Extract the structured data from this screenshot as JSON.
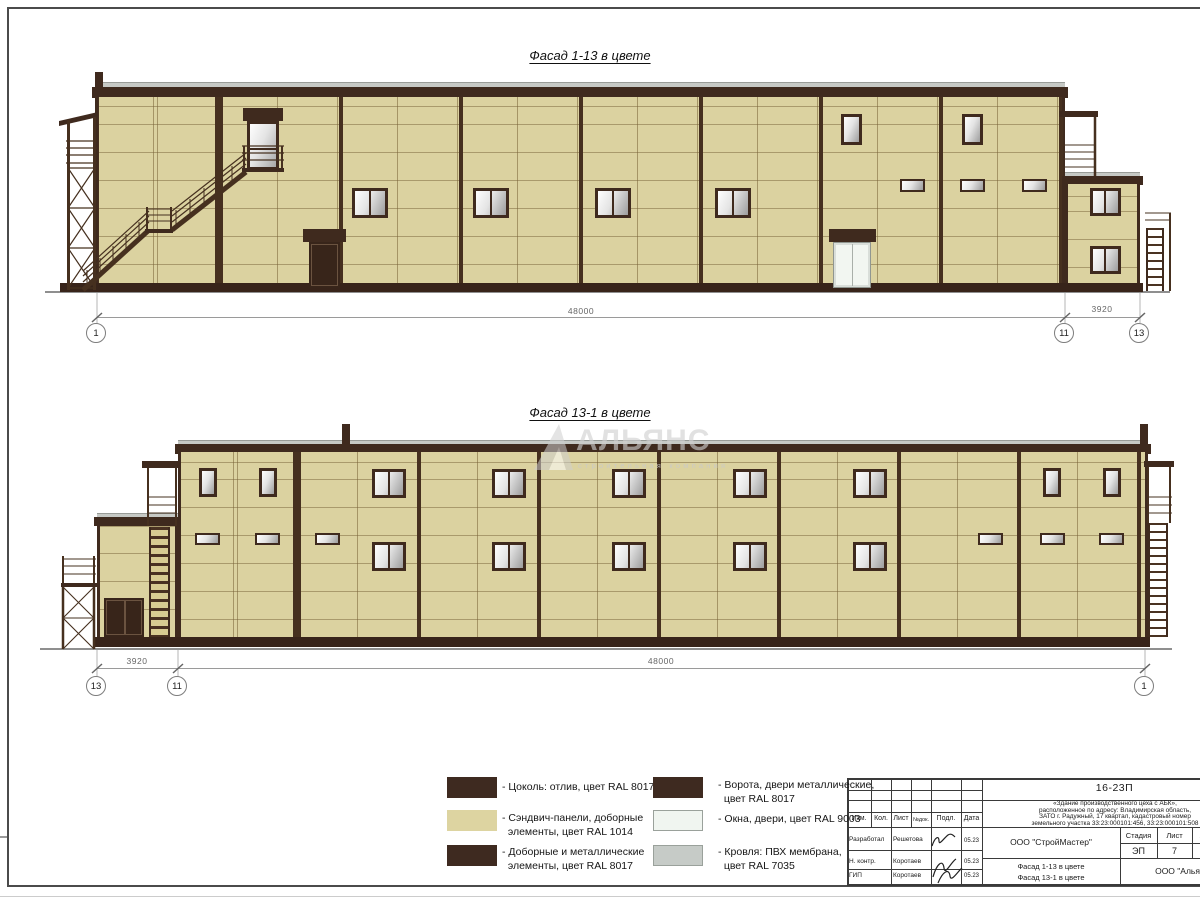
{
  "sheet": {
    "facade_top": {
      "title": "Фасад 1-13 в цвете",
      "dim_main": "48000",
      "dim_annex": "3920",
      "axis_left": "1",
      "axis_mid": "11",
      "axis_right": "13"
    },
    "facade_bottom": {
      "title": "Фасад 13-1 в цвете",
      "dim_annex": "3920",
      "dim_main": "48000",
      "axis_left": "13",
      "axis_mid": "11",
      "axis_right": "1"
    },
    "watermark": {
      "name": "АЛЬЯНС",
      "subtitle": "строительная компания"
    },
    "colors": {
      "panel_beige_ral1014": "#DDD4A1",
      "trim_brown_ral8017": "#3E2A20",
      "window_white_ral9003": "#F0F5F0",
      "roof_gray_ral7035": "#C6CBC7"
    },
    "legend": {
      "items": [
        {
          "color": "#3E2A20",
          "label": "- Цоколь: отлив, цвет RAL 8017"
        },
        {
          "color": "#DDD4A1",
          "label": "- Сэндвич-панели, доборные\n  элементы, цвет RAL 1014"
        },
        {
          "color": "#3E2A20",
          "label": "- Доборные и металлические\n  элементы, цвет RAL 8017"
        },
        {
          "color": "#3E2A20",
          "label": "- Ворота, двери металлические,\n  цвет RAL 8017"
        },
        {
          "color": "#F0F5F0",
          "label": "- Окна, двери, цвет RAL 9003"
        },
        {
          "color": "#C6CBC7",
          "label": "- Кровля: ПВХ мембрана,\n  цвет RAL 7035"
        }
      ]
    },
    "titleblock": {
      "doc_number": "16-23П",
      "description": "«Здание производственного цеха с АБК»,\nрасположенное по адресу: Владимирская область,\nЗАТО г. Радужный, 17 квартал, кадастровый номер\nземельного участка 33:23:000101:456, 33:23:000101:508",
      "cols": {
        "c1": "Изм.",
        "c2": "Кол.",
        "c3": "Лист",
        "c4": "№док.",
        "c5": "Подл.",
        "c6": "Дата"
      },
      "rows": [
        {
          "role": "Разработал",
          "name": "Решетова",
          "date": "05.23"
        },
        {
          "role": "Н. контр.",
          "name": "Коротаев",
          "date": "05.23"
        },
        {
          "role": "ГИП",
          "name": "Коротаев",
          "date": "05.23"
        }
      ],
      "company": "ООО \"СтройМастер\"",
      "stage_label": "Стадия",
      "sheet_label": "Лист",
      "sheets_label": "Листов",
      "stage": "ЭП",
      "sheet_no": "7",
      "sheets_total": "1",
      "sheet_titles": "Фасад 1-13 в цвете\nФасад 13-1 в цвете",
      "contractor": "ООО \"Альянс\""
    }
  }
}
